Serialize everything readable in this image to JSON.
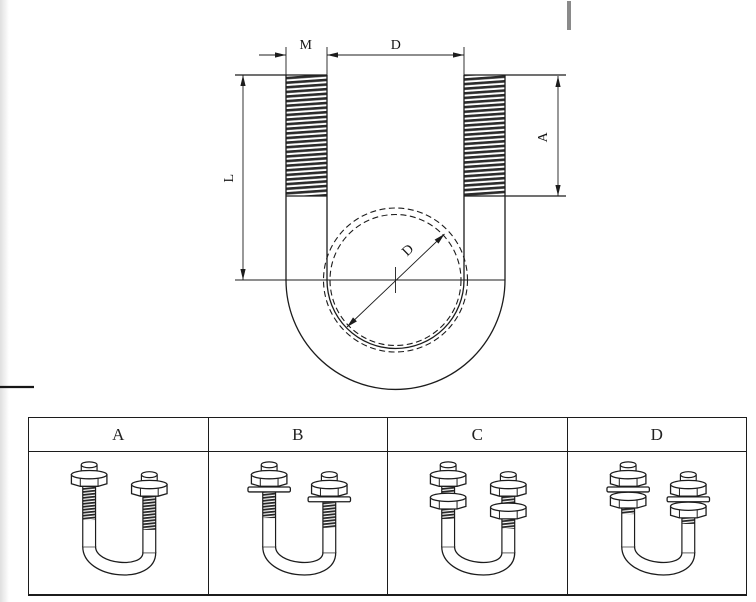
{
  "drawing": {
    "labels": {
      "m": "M",
      "d_top": "D",
      "l": "L",
      "a": "A",
      "d_diameter": "D"
    }
  },
  "table": {
    "columns": [
      {
        "label": "A",
        "hardware": "nut"
      },
      {
        "label": "B",
        "hardware": "nut-washer"
      },
      {
        "label": "C",
        "hardware": "double-nut"
      },
      {
        "label": "D",
        "hardware": "double-nut-washer"
      }
    ]
  },
  "colors": {
    "line": "#1c1c1c",
    "background": "#ffffff",
    "scan_mark_gray": "#8a8a8a"
  }
}
